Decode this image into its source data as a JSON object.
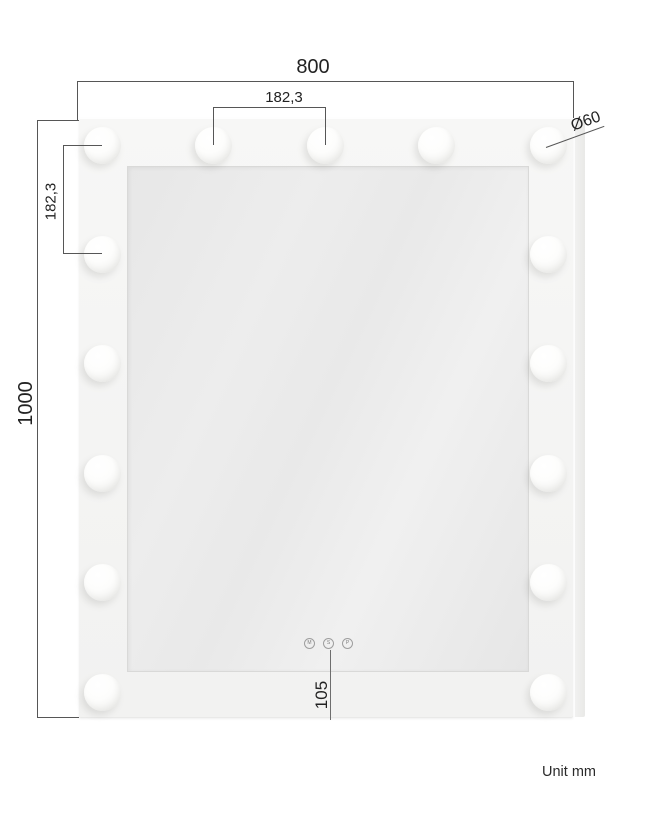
{
  "diagram": {
    "unit_note": "Unit mm",
    "dimensions": {
      "width": "800",
      "height": "1000",
      "bulb_spacing_horizontal": "182,3",
      "bulb_spacing_vertical": "182,3",
      "bulb_diameter": "Ø60",
      "control_offset_bottom": "105"
    },
    "bulbs": {
      "count": 15,
      "top_row": 5,
      "side_column": 6
    },
    "touch_buttons": [
      "M",
      "S",
      "P"
    ]
  }
}
